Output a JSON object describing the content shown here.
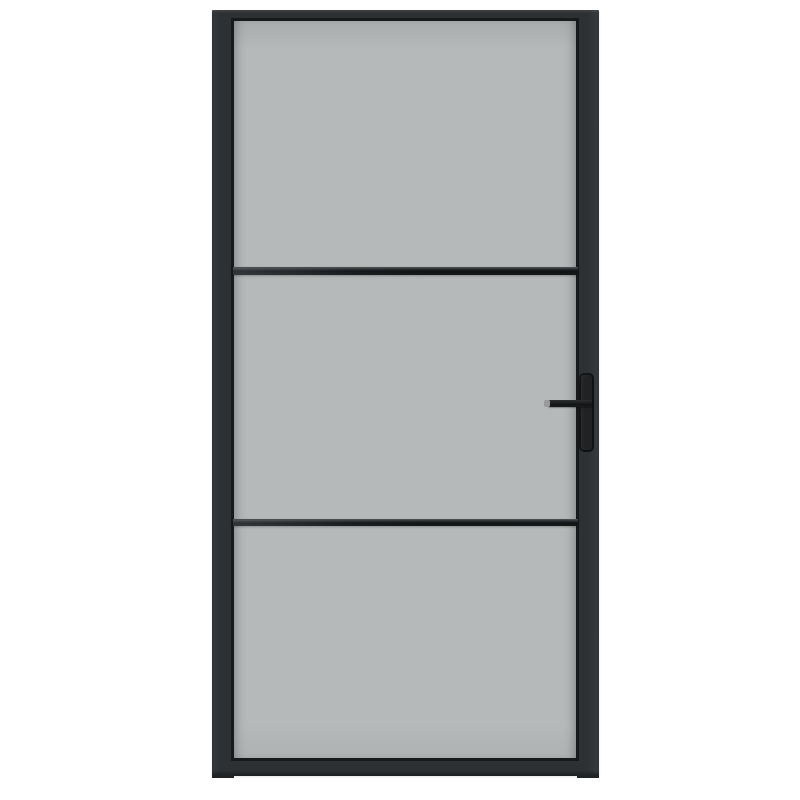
{
  "scene": {
    "kind": "product-photo",
    "subject": "Industrial-style interior door with black metal frame, frosted grey glass in three horizontal panels, two slim black glazing bars, and a black lever handle on a rectangular backplate on the right side",
    "background_color": "#ffffff"
  },
  "door": {
    "frame_finish": "matte black",
    "glass_finish": "frosted grey",
    "panel_count": 3,
    "glazing_bar_count": 2,
    "handle_side": "right",
    "handle_type": "lever-on-backplate",
    "handle_tip_finish": "grey metal"
  },
  "colors": {
    "bg": "#ffffff",
    "frame": "#2e3133",
    "frame-edge": "#17191a",
    "glass": "#b6b9b9",
    "bar-dark": "#101214",
    "handle": "#202224",
    "handle-tip": "#97999a"
  }
}
